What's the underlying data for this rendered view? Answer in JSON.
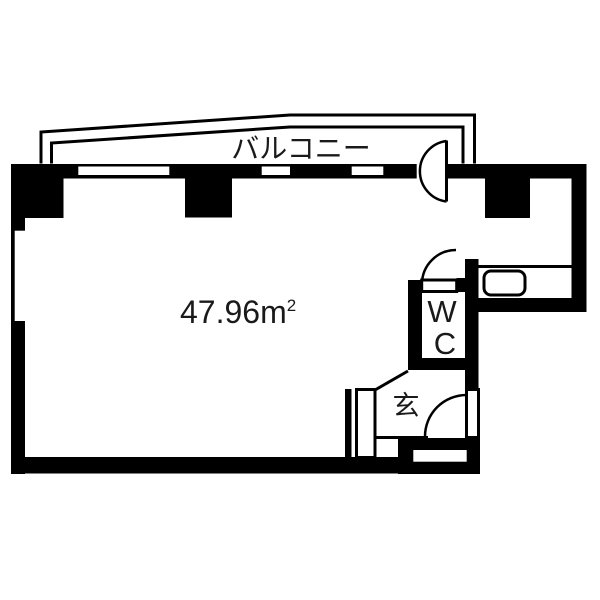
{
  "plan": {
    "labels": {
      "balcony": "バルコニー",
      "area_value": "47.96",
      "area_unit": "m",
      "area_exponent": "2",
      "wc_top": "W",
      "wc_bottom": "C",
      "entrance": "玄"
    },
    "colors": {
      "wall": "#000000",
      "background": "#ffffff",
      "text": "#1a1a1a"
    }
  }
}
